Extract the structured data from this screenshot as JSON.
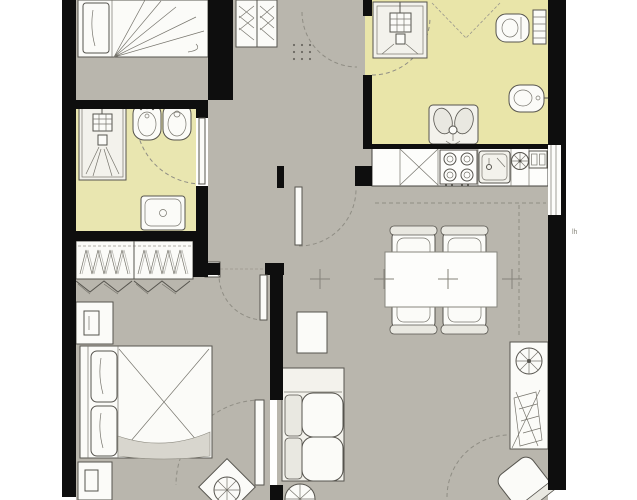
{
  "document": {
    "kind": "apartment floor plan drawing",
    "right_margin_mark": "lh"
  },
  "palette": {
    "paper": "#ffffff",
    "wall": "#0e0e0e",
    "floor_gray": "#b9b6ad",
    "bath_floor_left": "#e9e6b0",
    "bath_floor_right": "#e9e5a9",
    "kitchen_band": "#fdfdfb",
    "furniture_white": "#fbfbf8",
    "sketch_line": "#56544e",
    "dash_line": "#8f8d84"
  },
  "rooms": [
    {
      "id": "bedroom-small",
      "label": "Small bedroom (top left)",
      "floor": "gray",
      "furniture": [
        "single-bed"
      ]
    },
    {
      "id": "bathroom-left",
      "label": "Bathroom (left)",
      "floor": "yellow",
      "furniture": [
        "shower",
        "bidet",
        "toilet",
        "washbasin"
      ]
    },
    {
      "id": "bedroom-master",
      "label": "Master bedroom (bottom left)",
      "floor": "gray",
      "furniture": [
        "hanger-wardrobe",
        "folding-doors",
        "nightstand",
        "double-bed",
        "nightstand",
        "plant"
      ]
    },
    {
      "id": "hall",
      "label": "Entrance hall",
      "floor": "gray",
      "furniture": [
        "hatched-wardrobe"
      ]
    },
    {
      "id": "bathroom-right",
      "label": "Bathroom (top right)",
      "floor": "yellow",
      "furniture": [
        "shower",
        "toilet",
        "towel-radiator",
        "bidet",
        "washbasin"
      ]
    },
    {
      "id": "kitchen",
      "label": "Kitchen row",
      "floor": "white",
      "furniture": [
        "counter-cross",
        "cooktop-4-burners",
        "sink",
        "extractor-fan",
        "appliance"
      ]
    },
    {
      "id": "living-dining",
      "label": "Living / dining room",
      "floor": "gray",
      "furniture": [
        "dining-table",
        "four-chairs",
        "coffee-table",
        "sofa",
        "floor-fan",
        "desk",
        "desk-wheel",
        "drafting-board",
        "desk-chair"
      ]
    }
  ],
  "markers": {
    "survey_crosses": 4,
    "door_swings": 8,
    "window_right_wall": 1
  }
}
